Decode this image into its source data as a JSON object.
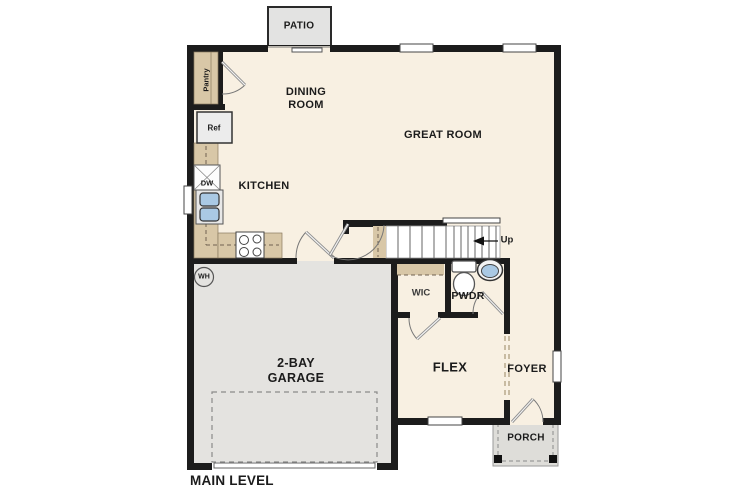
{
  "plan": {
    "title": "MAIN LEVEL",
    "rooms": {
      "patio": "PATIO",
      "dining_room": "DINING ROOM",
      "great_room": "GREAT ROOM",
      "kitchen": "KITCHEN",
      "garage": "2-BAY GARAGE",
      "wic": "WIC",
      "pwdr": "PWDR",
      "flex": "FLEX",
      "foyer": "FOYER",
      "porch": "PORCH"
    },
    "fixtures": {
      "pantry": "Pantry",
      "ref": "Ref",
      "dw": "DW",
      "wh": "WH",
      "up": "Up"
    },
    "colors": {
      "floor": "#f8f0e2",
      "garage_floor": "#e4e3e0",
      "patio_floor": "#e3e3e2",
      "porch_floor": "#deddd9",
      "wall": "#1c1c1c",
      "counter": "#d8c7a7",
      "sink_blue": "#aac9e4"
    }
  }
}
